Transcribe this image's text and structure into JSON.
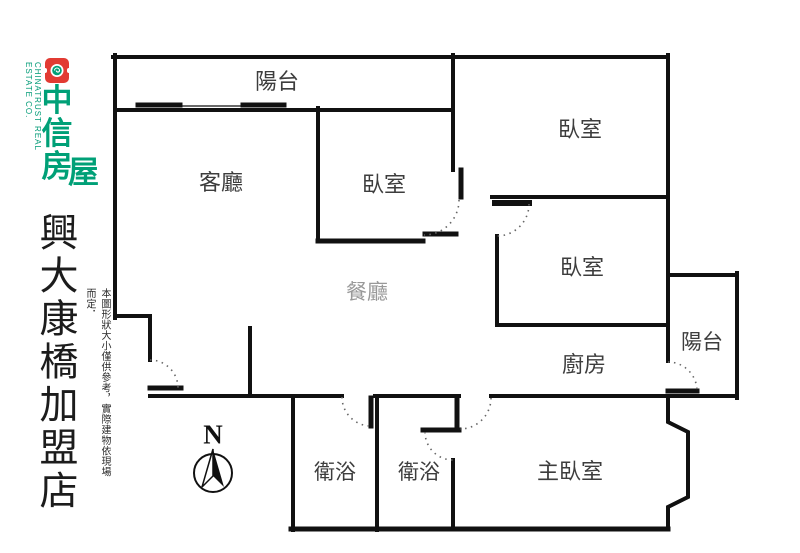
{
  "branding": {
    "company_en": "CHINATRUST REAL ESTATE CO.",
    "company_cn_stack": "中信房",
    "company_cn_last": "屋",
    "store_name": "興大康橋加盟店",
    "disclaimer": "本圖形狀大小僅供參考，實際建物依現場而定．",
    "brand_green": "#00A077",
    "brand_red": "#E23B33"
  },
  "floorplan": {
    "wall_color": "#111111",
    "door_arc_color": "#666666",
    "dining_label_color": "#999999",
    "compass_label": "N",
    "rooms": [
      {
        "id": "balcony-top",
        "label": "陽台"
      },
      {
        "id": "living-room",
        "label": "客廳"
      },
      {
        "id": "bedroom-center",
        "label": "臥室"
      },
      {
        "id": "bedroom-top-right",
        "label": "臥室"
      },
      {
        "id": "bedroom-mid-right",
        "label": "臥室"
      },
      {
        "id": "dining-room",
        "label": "餐廳"
      },
      {
        "id": "kitchen",
        "label": "廚房"
      },
      {
        "id": "balcony-right",
        "label": "陽台"
      },
      {
        "id": "bathroom-left",
        "label": "衛浴"
      },
      {
        "id": "bathroom-right",
        "label": "衛浴"
      },
      {
        "id": "master-bedroom",
        "label": "主臥室"
      }
    ]
  }
}
